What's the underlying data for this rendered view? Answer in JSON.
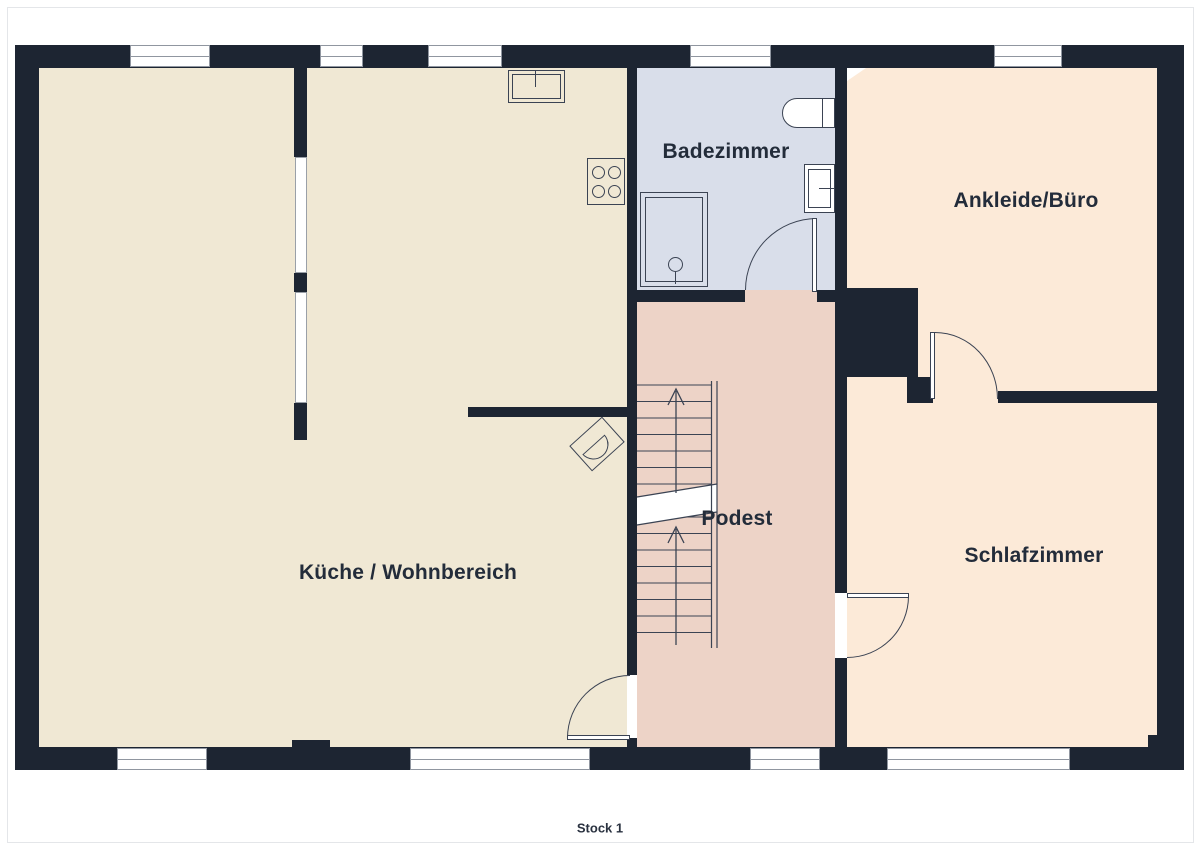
{
  "title": "Stock 1",
  "rooms": {
    "kitchen_living": {
      "label": "Küche / Wohnbereich",
      "floor_color": "#f0e8d4"
    },
    "bathroom": {
      "label": "Badezimmer",
      "floor_color": "#d9deea"
    },
    "dressing_office": {
      "label": "Ankleide/Büro",
      "floor_color": "#fcead8"
    },
    "bedroom": {
      "label": "Schlafzimmer",
      "floor_color": "#fcead8"
    },
    "landing": {
      "label": "Podest",
      "floor_color": "#edd3c7"
    }
  },
  "colors": {
    "wall": "#1d2532",
    "fixture_outline": "#3b4353",
    "window_fill": "#ffffff",
    "window_frame": "#9096a0",
    "label_text": "#232c3a",
    "page_border": "#e4e6e9",
    "background": "#ffffff"
  },
  "icons": [
    "stove-icon",
    "kitchen-sink-icon",
    "shower-icon",
    "toilet-icon",
    "washbasin-icon",
    "stairs-icon",
    "stairs-up-arrow-icon",
    "armchair-icon",
    "door-swing-icon"
  ]
}
